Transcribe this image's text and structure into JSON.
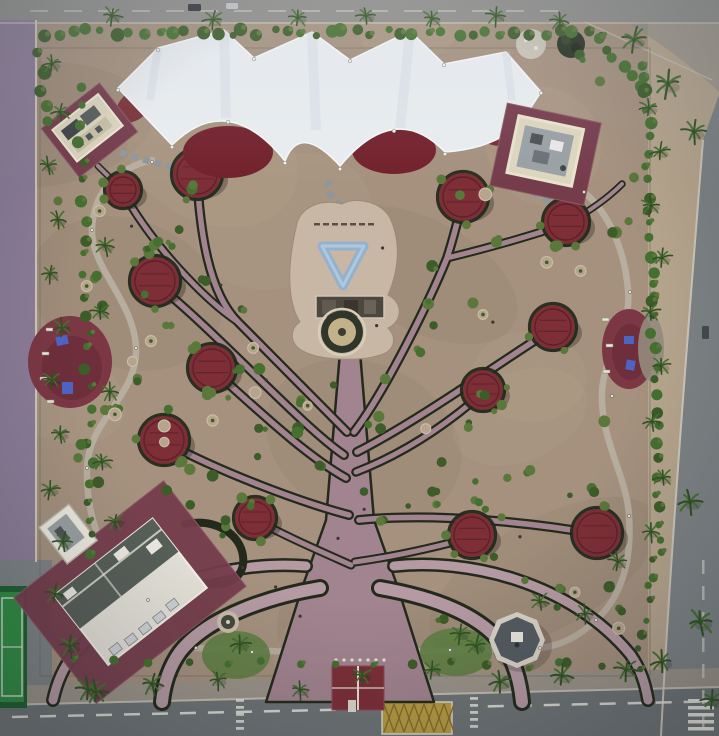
{
  "meta": {
    "kind": "aerial-park-photograph",
    "width": 719,
    "height": 736
  },
  "palette": {
    "dirt": "#a5917e",
    "dirtLight": "#b7a48e",
    "dirtDark": "#8b7b6a",
    "sand": "#b7a68e",
    "roadTop": "#8e8e8a",
    "roadBottom": "#6e7476",
    "roadRight": "#7e8486",
    "purpleRoad": "#8c7d98",
    "sidewalk": "#9b9489",
    "kerb": "#cfc9bc",
    "white": "#f0efe9",
    "marking": "#e6e6df",
    "markDim": "#c9c9c0",
    "yellowBox": "#c2a23c",
    "yellowDark": "#8a6f2a",
    "canopy": "#e9edf0",
    "canopyShade": "#c7d2da",
    "maroonShade": "#72212c",
    "pergola": "#7d2e37",
    "pergolaDark": "#541e26",
    "hedge": "#232a1b",
    "pathMauve": "#a28490",
    "pathLight": "#b59aa3",
    "plaza": "#c8b7a4",
    "blueArt": "#8cb2d4",
    "fountainRing": "#30372a",
    "fountainInner": "#c2b189",
    "loopPath": "#b8aea0",
    "stone": "#8f969c",
    "palm": "#45702f",
    "palmDark": "#2f5223",
    "shrub": "#59783a",
    "shrubDark": "#3c5c28",
    "lawn": "#5f7f42",
    "courtGreen": "#2f8f43",
    "courtDark": "#1d6130",
    "padMaroon": "#753c4c",
    "padMaroonLight": "#8d5a66",
    "cream": "#ddd6bf",
    "creamBright": "#ece9df",
    "roofGrey": "#9aa1a5",
    "roofDark": "#575f59",
    "structDark": "#4c473f",
    "equipBlue": "#4f63c4",
    "benchWhite": "#e9e7da",
    "binDark": "#3b382f",
    "stoneMound": "#ccc5b8",
    "darkMound": "#273122",
    "gazeboRim": "#d9d4c7",
    "gazeboTop": "#545b61",
    "shadow": "#1a1510"
  },
  "scene": {
    "canopy_circles": [
      [
        123,
        190,
        17
      ],
      [
        197,
        174,
        24
      ],
      [
        155,
        281,
        24
      ],
      [
        212,
        368,
        23
      ],
      [
        164,
        440,
        24
      ],
      [
        255,
        518,
        20
      ],
      [
        463,
        197,
        24
      ],
      [
        566,
        222,
        22
      ],
      [
        553,
        327,
        22
      ],
      [
        483,
        390,
        20
      ],
      [
        472,
        535,
        22
      ],
      [
        597,
        533,
        24
      ]
    ],
    "tree": {
      "trunk_points": "340,352 360,352 374,520 398,588 434,702 266,702 302,588 326,520",
      "branches": [
        {
          "d": "M347,432 C315,400 268,352 238,322 C208,292 200,230 197,176",
          "w1": 10,
          "w2": 5.5
        },
        {
          "d": "M238,322 C205,300 152,245 123,192",
          "w1": 9,
          "w2": 5
        },
        {
          "d": "M344,455 C300,425 215,330 155,283",
          "w1": 10,
          "w2": 5.5
        },
        {
          "d": "M346,478 C305,455 258,410 213,370",
          "w1": 10,
          "w2": 5.5
        },
        {
          "d": "M349,515 C300,502 220,472 165,442",
          "w1": 10,
          "w2": 5.5
        },
        {
          "d": "M351,565 C322,552 285,536 256,520",
          "w1": 9,
          "w2": 5
        },
        {
          "d": "M354,432 C385,392 430,300 447,258 C456,230 459,214 463,199",
          "w1": 10,
          "w2": 5.5
        },
        {
          "d": "M447,258 C492,247 536,234 566,224",
          "w1": 9,
          "w2": 5
        },
        {
          "d": "M357,452 C420,420 500,362 553,329",
          "w1": 10,
          "w2": 5.5
        },
        {
          "d": "M356,472 C408,452 452,420 484,392",
          "w1": 9.5,
          "w2": 5
        },
        {
          "d": "M359,520 C440,512 540,524 596,534",
          "w1": 10,
          "w2": 5.5
        },
        {
          "d": "M355,562 C398,556 440,546 473,537",
          "w1": 9,
          "w2": 5
        },
        {
          "d": "M566,224 C592,210 610,196 622,184",
          "w1": 7.5,
          "w2": 4
        },
        {
          "d": "M123,190 C112,180 104,172 98,166",
          "w1": 7,
          "w2": 4
        }
      ],
      "roots": [
        {
          "d": "M320,588 C272,596 208,616 180,652 C170,666 164,682 162,702",
          "w1": 18,
          "w2": 12
        },
        {
          "d": "M306,566 C232,560 132,586 74,654 C63,668 57,682 53,700",
          "w1": 14,
          "w2": 9
        },
        {
          "d": "M380,588 C426,596 482,612 506,650 C515,664 520,682 522,702",
          "w1": 18,
          "w2": 12
        },
        {
          "d": "M394,566 C468,558 570,582 630,654 C640,668 645,682 648,700",
          "w1": 14,
          "w2": 9
        }
      ],
      "hedge_only": [
        {
          "d": "M185,524 C216,518 240,534 243,556 C246,578 227,588 204,583",
          "w": 8
        }
      ],
      "arch_lawns": [
        [
          236,
          655,
          34,
          24
        ],
        [
          456,
          652,
          36,
          24
        ]
      ]
    },
    "palms": [
      [
        52,
        64
      ],
      [
        60,
        112
      ],
      [
        48,
        166
      ],
      [
        58,
        220
      ],
      [
        50,
        274
      ],
      [
        62,
        328
      ],
      [
        52,
        380
      ],
      [
        60,
        434
      ],
      [
        50,
        490
      ],
      [
        63,
        542
      ],
      [
        55,
        594
      ],
      [
        70,
        646,
        1.2
      ],
      [
        88,
        690,
        1.3
      ],
      [
        112,
        16
      ],
      [
        213,
        20
      ],
      [
        298,
        18
      ],
      [
        366,
        16
      ],
      [
        432,
        19
      ],
      [
        496,
        16
      ],
      [
        560,
        21
      ],
      [
        634,
        40,
        1.3
      ],
      [
        668,
        84,
        1.4
      ],
      [
        694,
        132,
        1.2
      ],
      [
        649,
        108
      ],
      [
        660,
        152
      ],
      [
        651,
        206
      ],
      [
        662,
        258
      ],
      [
        650,
        312
      ],
      [
        661,
        366
      ],
      [
        652,
        422
      ],
      [
        663,
        478
      ],
      [
        651,
        532
      ],
      [
        690,
        502,
        1.3
      ],
      [
        700,
        622,
        1.4
      ],
      [
        662,
        662,
        1.2
      ],
      [
        712,
        700,
        1.2
      ],
      [
        96,
        692,
        1.2
      ],
      [
        152,
        684,
        1.2
      ],
      [
        218,
        680
      ],
      [
        300,
        690
      ],
      [
        362,
        676
      ],
      [
        432,
        670
      ],
      [
        500,
        682,
        1.2
      ],
      [
        562,
        676,
        1.2
      ],
      [
        626,
        670,
        1.2
      ],
      [
        240,
        644,
        1.1
      ],
      [
        476,
        646,
        1.1
      ],
      [
        105,
        246
      ],
      [
        100,
        312
      ],
      [
        110,
        392
      ],
      [
        102,
        462
      ],
      [
        115,
        522
      ],
      [
        585,
        614
      ],
      [
        540,
        602
      ],
      [
        460,
        634
      ],
      [
        618,
        562
      ]
    ],
    "hedgerows": [
      {
        "x1": 44,
        "y1": 32,
        "x2": 600,
        "y2": 34,
        "n": 40,
        "r": 5
      },
      {
        "x1": 598,
        "y1": 40,
        "x2": 648,
        "y2": 92,
        "n": 7,
        "r": 5
      },
      {
        "x1": 646,
        "y1": 64,
        "x2": 652,
        "y2": 300,
        "n": 17,
        "r": 4.5
      },
      {
        "x1": 652,
        "y1": 300,
        "x2": 660,
        "y2": 556,
        "n": 17,
        "r": 4.5
      },
      {
        "x1": 654,
        "y1": 560,
        "x2": 640,
        "y2": 646,
        "n": 7,
        "r": 4
      },
      {
        "x1": 80,
        "y1": 88,
        "x2": 92,
        "y2": 556,
        "n": 26,
        "r": 4.5
      },
      {
        "x1": 74,
        "y1": 660,
        "x2": 640,
        "y2": 666,
        "n": 16,
        "r": 4
      },
      {
        "x1": 40,
        "y1": 56,
        "x2": 44,
        "y2": 120,
        "n": 5,
        "r": 5
      }
    ],
    "canopy_posts": [
      [
        118,
        90
      ],
      [
        172,
        147
      ],
      [
        228,
        122
      ],
      [
        285,
        163
      ],
      [
        340,
        169
      ],
      [
        394,
        131
      ],
      [
        445,
        154
      ],
      [
        524,
        119
      ],
      [
        158,
        50
      ],
      [
        254,
        59
      ],
      [
        350,
        61
      ],
      [
        444,
        65
      ],
      [
        541,
        93
      ]
    ],
    "lamps": [
      [
        152,
        162
      ],
      [
        92,
        230
      ],
      [
        136,
        348
      ],
      [
        87,
        468
      ],
      [
        148,
        600
      ],
      [
        196,
        648
      ],
      [
        540,
        648
      ],
      [
        596,
        620
      ],
      [
        629,
        516
      ],
      [
        612,
        396
      ],
      [
        630,
        292
      ],
      [
        584,
        192
      ],
      [
        252,
        652
      ],
      [
        450,
        650
      ]
    ],
    "cars": [
      {
        "x": 188,
        "y": 4,
        "w": 13,
        "h": 7,
        "c": "#2e3338"
      },
      {
        "x": 226,
        "y": 3,
        "w": 12,
        "h": 6,
        "c": "#c2c5c8"
      },
      {
        "x": 702,
        "y": 326,
        "w": 7,
        "h": 13,
        "c": "#454a50"
      }
    ],
    "benches": [
      [
        46,
        328
      ],
      [
        42,
        352
      ],
      [
        40,
        377
      ],
      [
        47,
        400
      ],
      [
        602,
        318
      ],
      [
        606,
        344
      ],
      [
        603,
        370
      ]
    ],
    "plaza_bench_row": {
      "x": 314,
      "y": 223,
      "n": 7,
      "dx": 9
    }
  }
}
